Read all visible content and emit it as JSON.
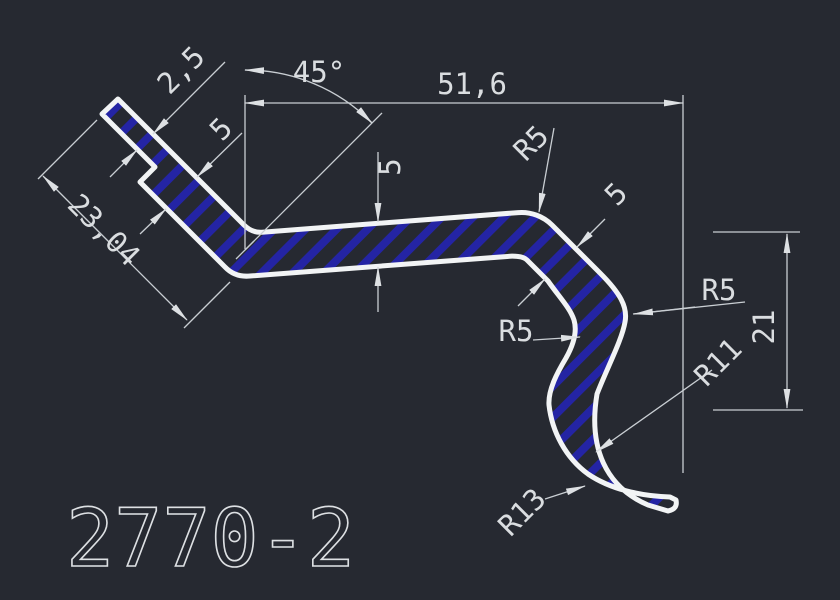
{
  "drawing": {
    "number": "2770-2",
    "background_color": "#262931",
    "outline_color": "#f2f4f5",
    "dimension_color": "#c9ced3",
    "hatch_color": "#2424a4"
  },
  "labels": {
    "lip_width": "2,5",
    "bend_angle": "45°",
    "overall_width": "51,6",
    "thickness_left": "5",
    "thickness_mid": "5",
    "thickness_right": "5",
    "flange_length": "23,04",
    "hook_height": "21",
    "radius_top": "R5",
    "radius_left": "R5",
    "radius_right": "R5",
    "radius_hook_inner": "R11",
    "radius_hook_outer": "R13"
  }
}
